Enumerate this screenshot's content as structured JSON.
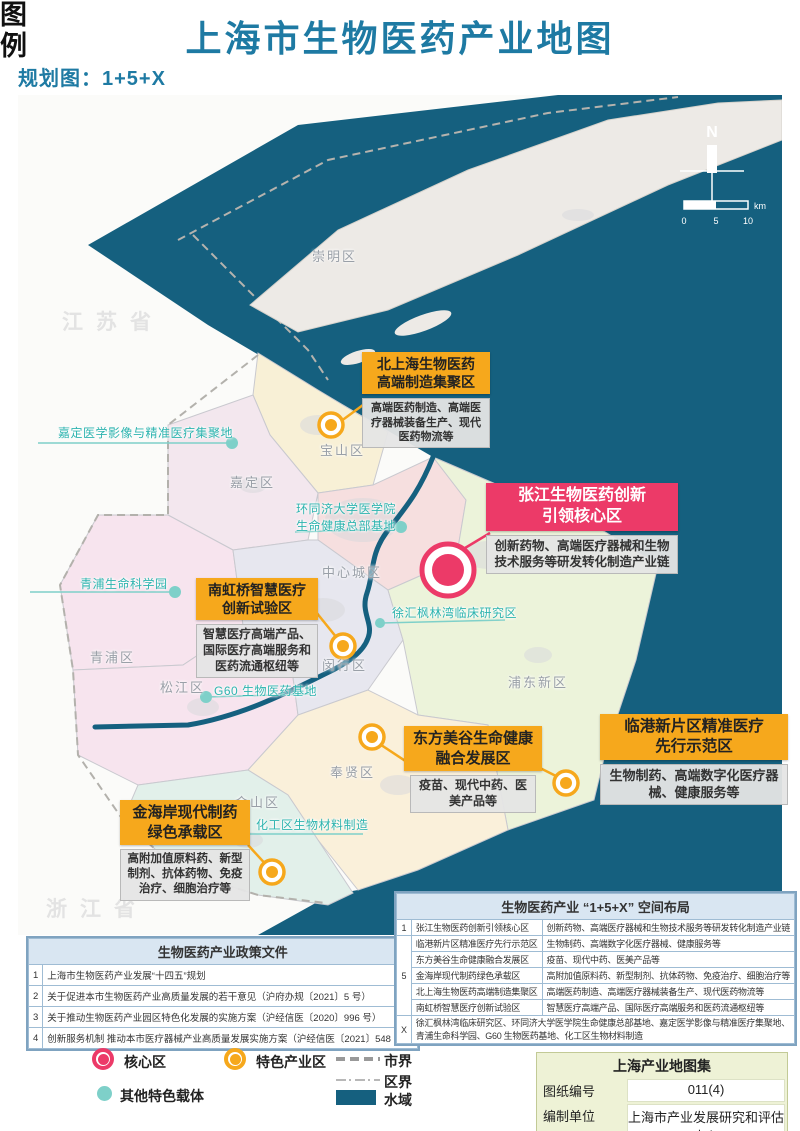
{
  "title": "上海市生物医药产业地图",
  "subtitle": "规划图：1+5+X",
  "compass": {
    "north": "N",
    "tick0": "0",
    "tick1": "5",
    "tick2": "10",
    "unit": "km"
  },
  "provinces": [
    "江苏省",
    "浙江省"
  ],
  "districts": [
    "崇明区",
    "宝山区",
    "嘉定区",
    "青浦区",
    "松江区",
    "闵行区",
    "中心城区",
    "浦东新区",
    "奉贤区",
    "金山区"
  ],
  "carriers": [
    "嘉定医学影像与精准医疗集聚地",
    "环同济大学医学院生命健康总部基地",
    "青浦生命科学园",
    "徐汇枫林湾临床研究区",
    "G60 生物医药基地",
    "化工区生物材料制造"
  ],
  "callouts": [
    {
      "line1": "北上海生物医药",
      "line2": "高端制造集聚区",
      "desc": "高端医药制造、高端医疗器械装备生产、现代医药物流等"
    },
    {
      "line1": "张江生物医药创新",
      "line2": "引领核心区",
      "desc": "创新药物、高端医疗器械和生物技术服务等研发转化制造产业链"
    },
    {
      "line1": "南虹桥智慧医疗",
      "line2": "创新试验区",
      "desc": "智慧医疗高端产品、国际医疗高端服务和医药流通枢纽等"
    },
    {
      "line1": "东方美谷生命健康",
      "line2": "融合发展区",
      "desc": "疫苗、现代中药、医美产品等"
    },
    {
      "line1": "临港新片区精准医疗",
      "line2": "先行示范区",
      "desc": "生物制药、高端数字化医疗器械、健康服务等"
    },
    {
      "line1": "金海岸现代制药",
      "line2": "绿色承载区",
      "desc": "高附加值原料药、新型制剂、抗体药物、免疫治疗、细胞治疗等"
    }
  ],
  "policy_table": {
    "title": "生物医药产业政策文件",
    "rows": [
      {
        "no": "1",
        "text": "上海市生物医药产业发展“十四五”规划"
      },
      {
        "no": "2",
        "text": "关于促进本市生物医药产业高质量发展的若干意见（沪府办规〔2021〕5 号）"
      },
      {
        "no": "3",
        "text": "关于推动生物医药产业园区特色化发展的实施方案（沪经信医〔2020〕996 号）"
      },
      {
        "no": "4",
        "text": "创新服务机制 推动本市医疗器械产业高质量发展实施方案（沪经信医〔2021〕548 号）"
      }
    ]
  },
  "layout_table": {
    "title": "生物医药产业 “1+5+X” 空间布局",
    "group1": "1",
    "group5": "5",
    "groupX": "X",
    "rows": [
      {
        "name": "张江生物医药创新引领核心区",
        "desc": "创新药物、高端医疗器械和生物技术服务等研发转化制造产业链"
      },
      {
        "name": "临港新片区精准医疗先行示范区",
        "desc": "生物制药、高端数字化医疗器械、健康服务等"
      },
      {
        "name": "东方美谷生命健康融合发展区",
        "desc": "疫苗、现代中药、医美产品等"
      },
      {
        "name": "金海岸现代制药绿色承载区",
        "desc": "高附加值原料药、新型制剂、抗体药物、免疫治疗、细胞治疗等"
      },
      {
        "name": "北上海生物医药高端制造集聚区",
        "desc": "高端医药制造、高端医疗器械装备生产、现代医药物流等"
      },
      {
        "name": "南虹桥智慧医疗创新试验区",
        "desc": "智慧医疗高端产品、国际医疗高端服务和医药流通枢纽等"
      }
    ],
    "x_text": "徐汇枫林湾临床研究区、环同济大学医学院生命健康总部基地、嘉定医学影像与精准医疗集聚地、青浦生命科学园、G60 生物医药基地、化工区生物材料制造"
  },
  "legend": {
    "title": "图例",
    "core": "核心区",
    "feature": "特色产业区",
    "other": "其他特色载体",
    "city_border": "市界",
    "district_border": "区界",
    "water": "水域"
  },
  "info_box": {
    "title": "上海产业地图集",
    "rows": [
      {
        "label": "图纸编号",
        "value": "011(4)"
      },
      {
        "label": "编制单位",
        "value": "上海市产业发展研究和评估中心"
      }
    ]
  },
  "colors": {
    "title_teal": "#1e7aa3",
    "water": "#15607f",
    "orange": "#f6a81c",
    "pink": "#ec3a68",
    "carrier_teal": "#2eb4af"
  }
}
